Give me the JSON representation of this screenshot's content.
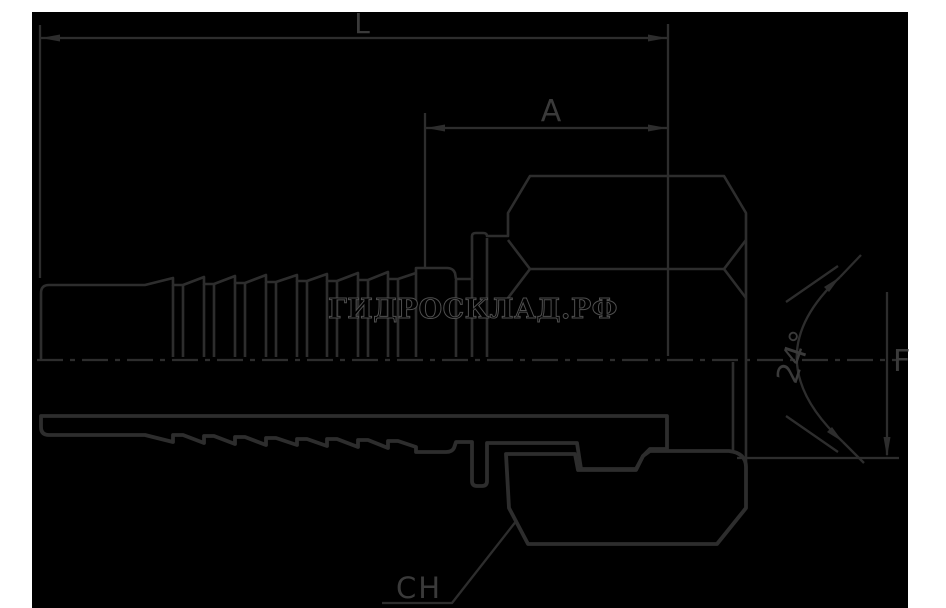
{
  "watermark": "ГИДРОСКЛАД.РФ",
  "labels": {
    "l": "L",
    "a": "A",
    "angle": "24°",
    "f": "F",
    "ch": "CH"
  },
  "drawing": {
    "type": "hydraulic-hose-fitting-half-section",
    "views": [
      "outside view above centerline",
      "hatched section below centerline"
    ],
    "dimensioned_features": {
      "L": "overall length",
      "A": "length from collar to sealing cone end",
      "24°": "sealing cone angle",
      "F": "thread / cone diameter",
      "CH": "wrench size across flats of nut"
    }
  },
  "colors": {
    "page_bg": "#ffffff",
    "canvas_bg": "#000000",
    "line": "#2d2d2d",
    "label_text": "#3a3a3a",
    "watermark_outline": "#4f4f4f"
  }
}
